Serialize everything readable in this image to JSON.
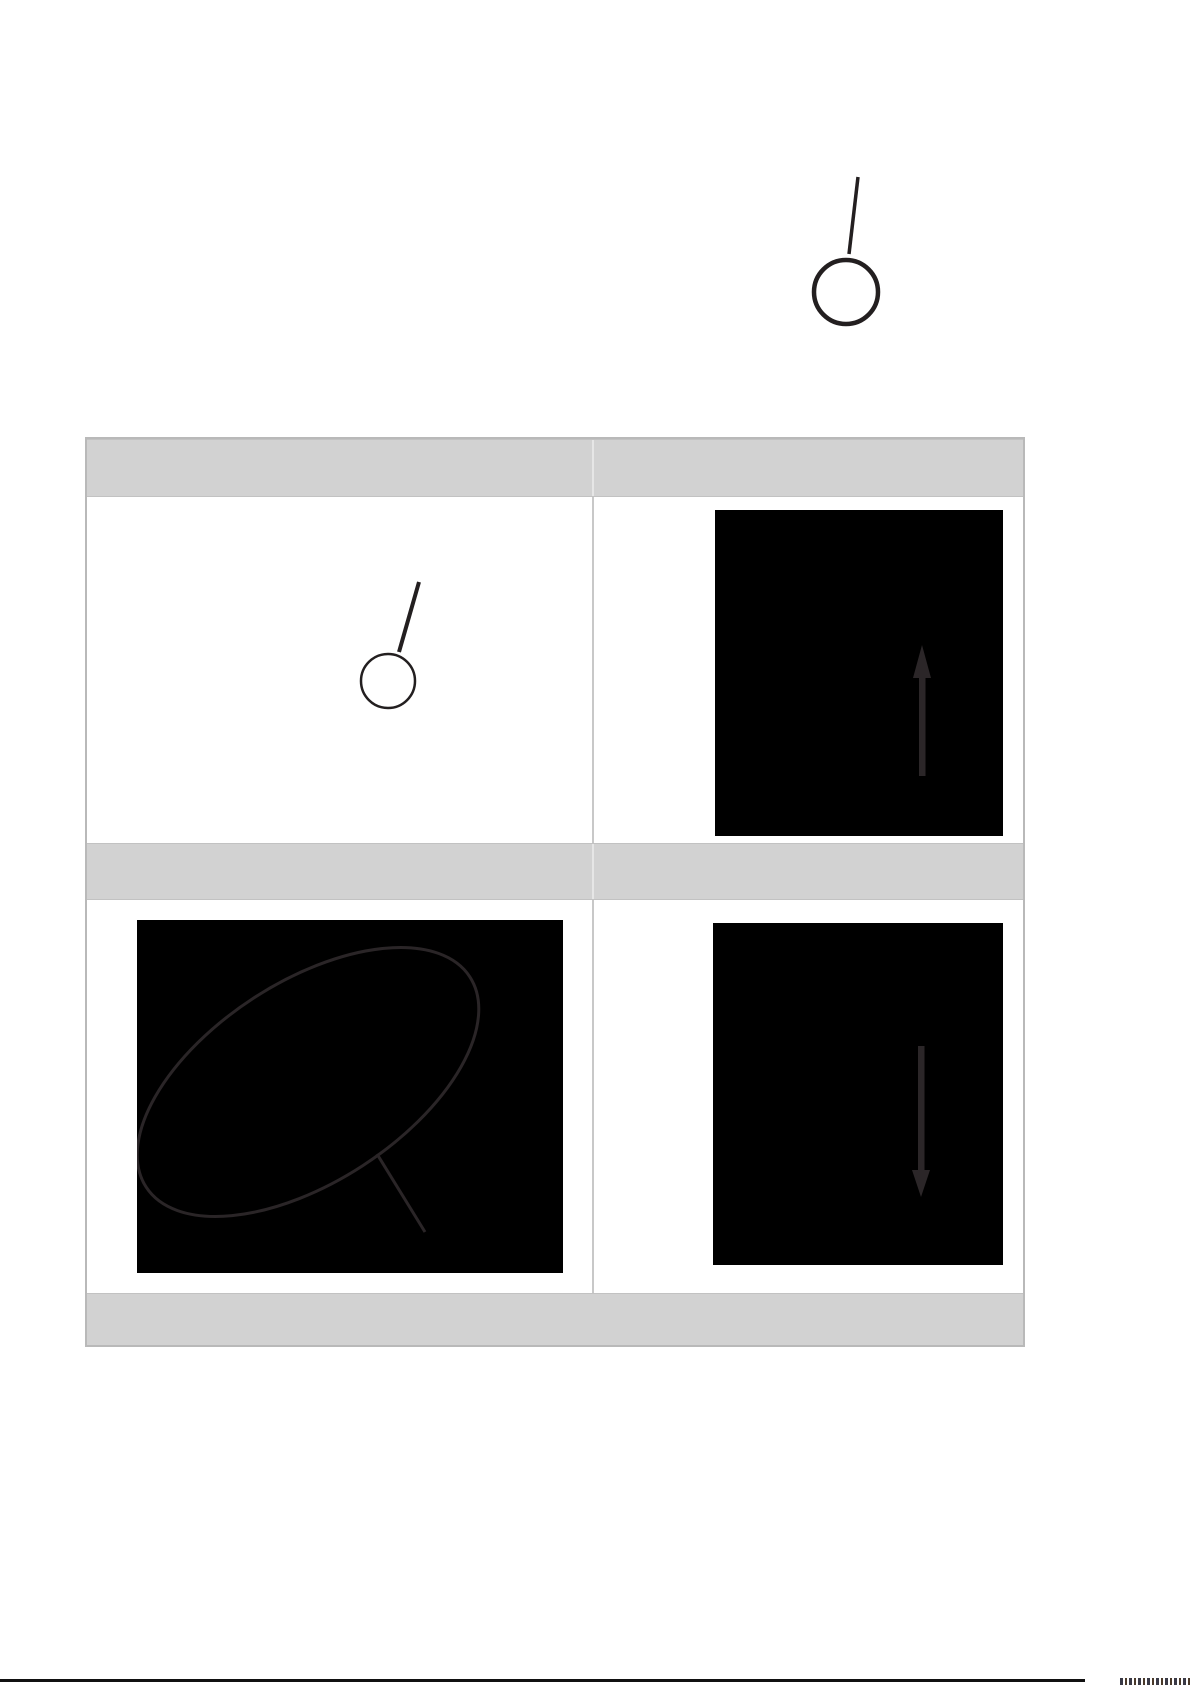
{
  "page": {
    "background_color": "#ffffff"
  },
  "top_figure": {
    "icon": "eject-pin-icon",
    "label": ""
  },
  "table": {
    "header_row_1": {
      "left_cell_text": "",
      "right_cell_text": ""
    },
    "row_1": {
      "left_figure_icon": "eject-pin-icon",
      "right_figure_icon": "arrow-up-icon",
      "left_cell_text": "",
      "right_cell_text": ""
    },
    "header_row_2": {
      "left_cell_text": "",
      "right_cell_text": ""
    },
    "row_2": {
      "left_figure_icon": "tilted-oval-with-handle-icon",
      "right_figure_icon": "arrow-down-icon",
      "left_cell_text": "",
      "right_cell_text": ""
    },
    "footer_row": {
      "cell_text": ""
    }
  },
  "colors": {
    "header_fill": "#d2d2d2",
    "table_border": "#b9b9b9",
    "inner_divider": "#c8c8c8",
    "panel_background": "#000000",
    "panel_stroke": "#2b2628",
    "pin_stroke": "#231f20",
    "bottom_rule": "#111111"
  }
}
